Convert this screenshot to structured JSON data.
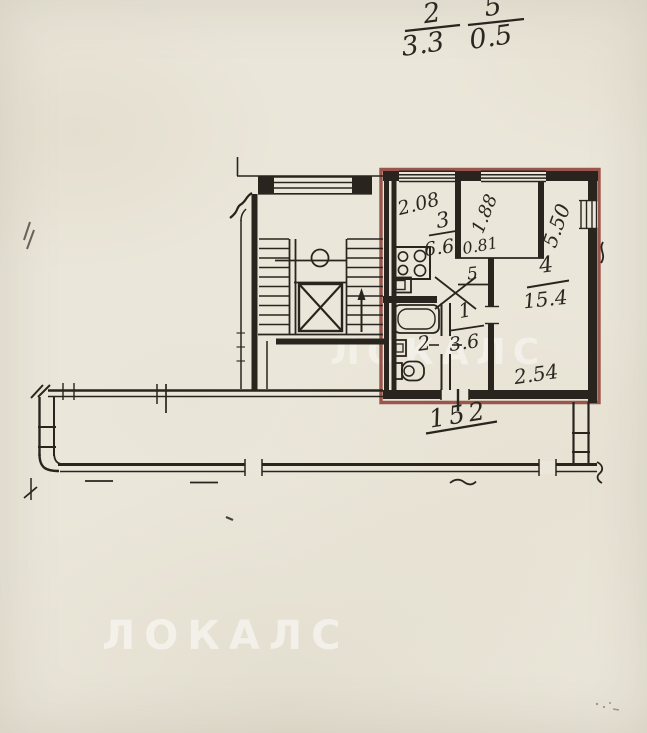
{
  "colors": {
    "paper": "#eae6d9",
    "ink": "#29251e",
    "red_boundary": "#8e4238",
    "watermark": "#ffffff"
  },
  "notes": {
    "fraction1": {
      "numerator": "2",
      "denominator": "3.3"
    },
    "fraction2": {
      "numerator": "5",
      "denominator": "0.5"
    }
  },
  "rooms": {
    "kitchen": {
      "num": "3",
      "area": "6.6"
    },
    "living": {
      "num": "4",
      "area": "15.4"
    },
    "hall": {
      "num": "1",
      "area": "3.6"
    },
    "bath": {
      "num": "2"
    },
    "closet": {
      "num": "5"
    }
  },
  "dims": {
    "kitchen_width": "2.08",
    "niche_height": "1.88",
    "niche_width": "0.81",
    "living_height": "5.50",
    "living_width": "2.54"
  },
  "unit": {
    "number": "152"
  },
  "watermark": {
    "text": "ЛОКАЛС"
  },
  "icons": {
    "stove": "stove-icon",
    "kitchen_sink": "sink-icon",
    "bathtub": "bathtub-icon",
    "washbasin": "washbasin-icon",
    "toilet": "toilet-icon",
    "elevator": "elevator-icon",
    "stairs": "stairs-icon",
    "stairs_direction": "up-arrow-icon"
  }
}
